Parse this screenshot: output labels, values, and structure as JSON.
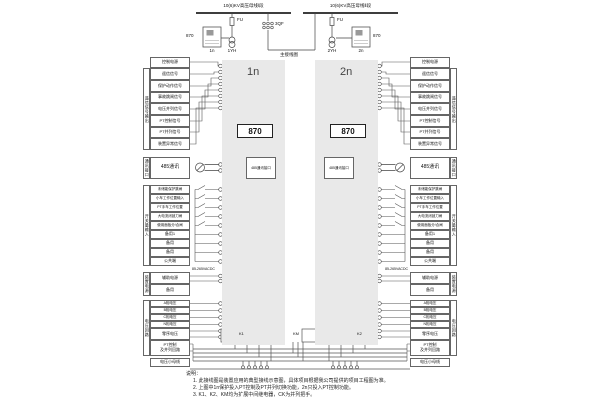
{
  "top": {
    "bus_left": "10(6)KV高压母线Ⅰ段",
    "bus_right": "10(6)KV高压母线Ⅱ段",
    "fu": "FU",
    "qf": "3QF",
    "pt_left": "1YH",
    "pt_right": "2YH",
    "cab_left": "1n",
    "cab_right": "2n",
    "dev": "870",
    "main_label": "主接线图"
  },
  "panels": {
    "left": "1n",
    "right": "2n",
    "device": "870"
  },
  "signals": {
    "header": "控制电源",
    "strip": "遥信信号输出",
    "rows": [
      "遥信信号",
      "保护动作信号",
      "事故跳闸信号",
      "电压并列信号",
      "PT控制信号",
      "PT并列信号",
      "装置异常信号"
    ]
  },
  "comm": {
    "strip": "通讯接口",
    "label": "485通讯",
    "module": "485通讯接口"
  },
  "di": {
    "strip": "开关量输入",
    "rows": [
      "未储能保护跳闸",
      "小车工作位置输入",
      "PT手车工作位置",
      "大电流闭锁刀闸",
      "使用面板分/合闸",
      "备用1",
      "备用",
      "备用",
      "公共端"
    ]
  },
  "power": {
    "strip": "装置电源",
    "rows": [
      "辅助电源",
      "备用"
    ],
    "range": "85-265VACDC"
  },
  "voltage": {
    "strip": "电压回路",
    "rows": [
      "A相电压",
      "B相电压",
      "C相电压",
      "N相电压"
    ],
    "zero": "零序电压",
    "pt_line1": "PT控制",
    "pt_line2": "及并列回路",
    "bus": "电压小母线"
  },
  "bottom": {
    "k1": "K1",
    "km": "KM",
    "k2": "K2"
  },
  "notes": {
    "title": "说明：",
    "lines": [
      "1. 此接线图是装置应用的典型接线示意图，具体项目根据我公司提供的项目工程图为准。",
      "2. 上图中1n保护投入PT控制及PT并列切换功能，2n只投入PT控制功能。",
      "3. K1、K2、KM均为扩展中间继电器，CK为并列把手。"
    ]
  }
}
